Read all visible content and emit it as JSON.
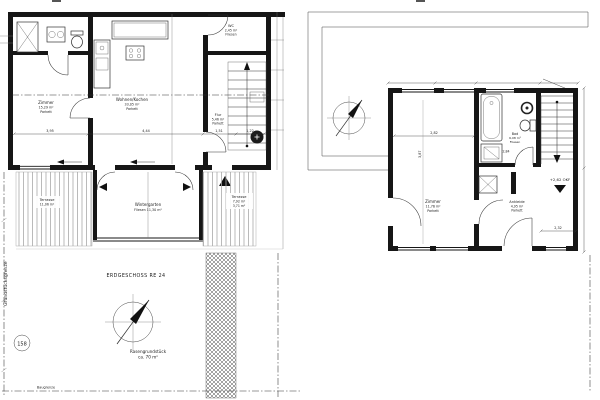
{
  "drawing": {
    "ground_floor": {
      "title": "ERDGESCHOSS RE 24",
      "rooms": {
        "zimmer": {
          "name": "Zimmer",
          "area": "15,29 m²",
          "floor": "Parkett"
        },
        "wohnen": {
          "name": "Wohnen/Kochen",
          "area": "33,05 m²",
          "floor": "Parkett"
        },
        "wc": {
          "name": "WC",
          "area": "2,45 m²",
          "floor": "Fliesen"
        },
        "flur": {
          "name": "Flur",
          "area": "5,46 m²",
          "floor": "Parkett"
        },
        "wintergarten": {
          "name": "Wintergarten",
          "detail": "Fliesen 11,30 m²"
        },
        "terrasse_links": {
          "name": "Terrasse",
          "area": "11,06 m²"
        },
        "terrasse_rechts": {
          "name": "Terrasse",
          "area": "7,92 m²",
          "area2": "3,71 m²"
        }
      },
      "dimensions": {
        "d1": "3,95",
        "d2": "4,44",
        "d3": "1,51",
        "d4": "1,22"
      },
      "site": {
        "parcel_number": "158",
        "lawn_label": "Rasengrundstück",
        "lawn_area": "ca. 70 m²",
        "boundary_left": "Grundstücksgrenze",
        "boundary_bottom": "Baugrenze"
      }
    },
    "upper_floor": {
      "rooms": {
        "zimmer": {
          "name": "Zimmer",
          "area": "11,76 m²",
          "floor": "Parkett"
        },
        "bad": {
          "name": "Bad",
          "area": "6,08 m²",
          "floor": "Fliesen"
        },
        "ankleide": {
          "name": "Ankleide",
          "area": "4,95 m²",
          "floor": "Parkett"
        }
      },
      "level_marker": "+2,62 OKF",
      "dimensions": {
        "w": "2,82",
        "h": "3,87",
        "bath": "2,84",
        "right": "2,32"
      }
    }
  }
}
